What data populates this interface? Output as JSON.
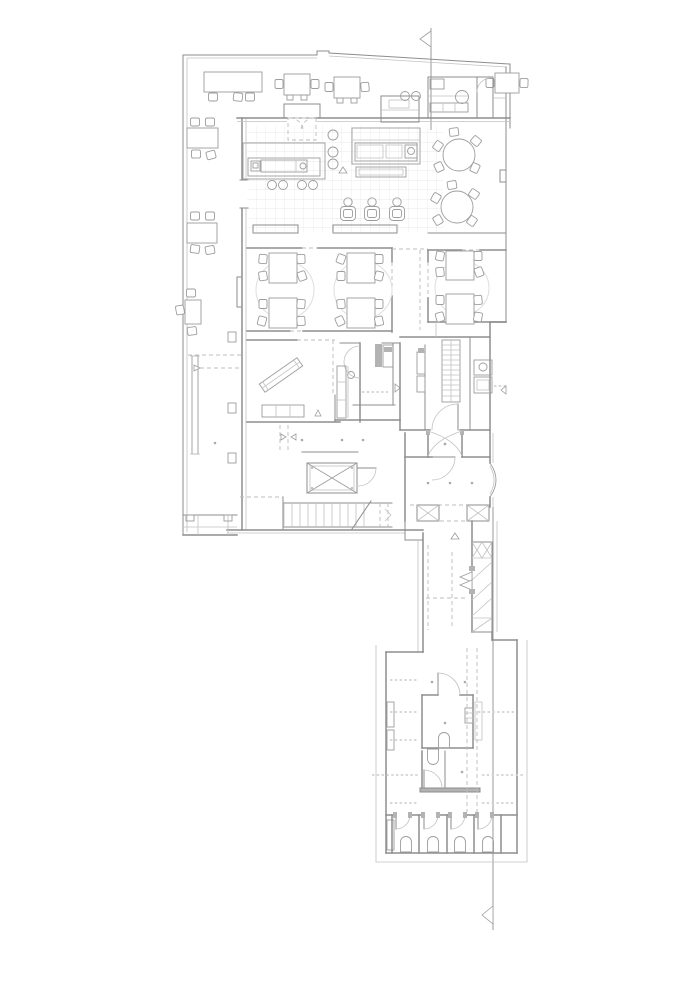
{
  "page": {
    "background": "#ffffff"
  },
  "drawing": {
    "type": "architectural floor plan (line drawing, no text labels)",
    "colors": {
      "bg": "#ffffff",
      "wall": "#8d8d8d",
      "furn": "#9d9d9d",
      "fine": "#c2c2c2",
      "faint": "#e0e0e0",
      "dashed": "#bcbcbc",
      "gdot": "#d2d2d2",
      "fillc": "#b3b3b3",
      "dotc": "#ababab",
      "section": "#9a9a9a",
      "grid": "#e4e4e4"
    },
    "features": {
      "section_markers": 2,
      "terrace_tables_top": 4,
      "terrace_tables_left": 3,
      "dining_groups": 3,
      "round_tables": 2,
      "bar_stools": 3,
      "wc_stalls": 4,
      "elevator": 1,
      "staircases": 1
    }
  }
}
